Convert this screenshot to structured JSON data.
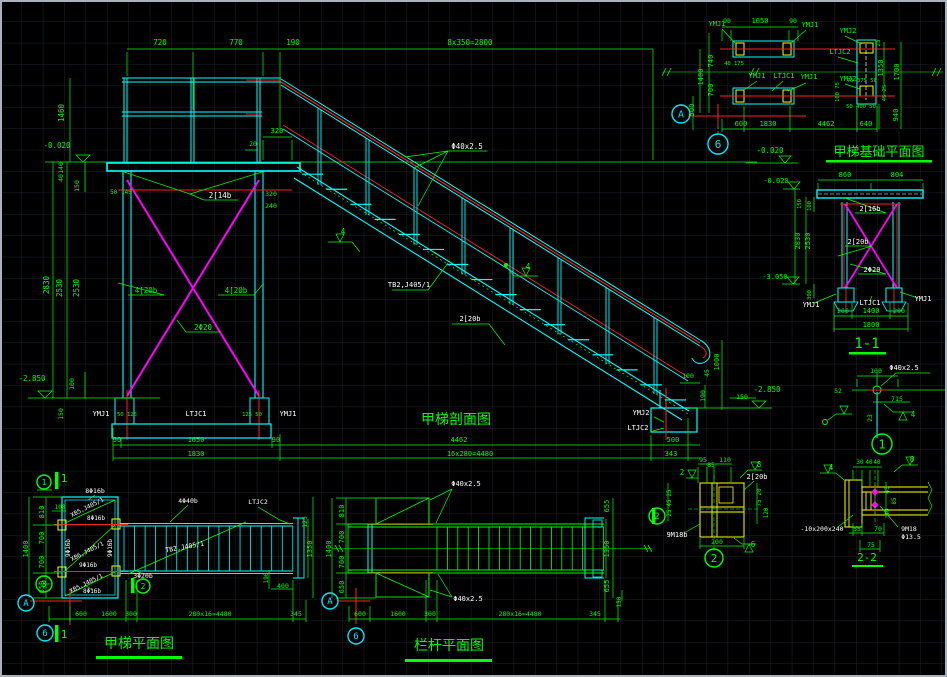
{
  "colors": {
    "line_cyan": "#00ffff",
    "line_green": "#00ff00",
    "line_red": "#ff2020",
    "line_magenta": "#ff00ff",
    "line_yellow": "#ffff00",
    "text_white": "#ffffff",
    "background": "#000000"
  },
  "views": {
    "foundation_plan": {
      "title": "甲梯基础平面图"
    },
    "section_1_1": {
      "title": "1-1"
    },
    "elevation": {
      "title": "甲梯剖面图"
    },
    "stair_plan": {
      "title": "甲梯平面图"
    },
    "railing_plan": {
      "title": "栏杆平面图"
    },
    "detail_2_2": {
      "title": "2-2"
    }
  },
  "texts": [
    {
      "x": 160,
      "y": 45,
      "t": "720"
    },
    {
      "x": 236,
      "y": 45,
      "t": "770"
    },
    {
      "x": 293,
      "y": 45,
      "t": "190"
    },
    {
      "x": 470,
      "y": 45,
      "t": "8x350=2800"
    },
    {
      "x": 64,
      "y": 113,
      "t": "1460",
      "r": -90
    },
    {
      "x": 57,
      "y": 148,
      "t": "-0.020"
    },
    {
      "x": 49,
      "y": 285,
      "t": "2830",
      "r": -90
    },
    {
      "x": 62,
      "y": 288,
      "t": "2530",
      "r": -90
    },
    {
      "x": 79,
      "y": 288,
      "t": "2530",
      "r": -90
    },
    {
      "x": 63,
      "y": 168,
      "t": "140",
      "r": -90,
      "s": 6.5
    },
    {
      "x": 63,
      "y": 178,
      "t": "40",
      "r": -90,
      "s": 6.5
    },
    {
      "x": 79,
      "y": 186,
      "t": "150",
      "r": -90,
      "s": 6.5
    },
    {
      "x": 74,
      "y": 384,
      "t": "100",
      "r": -90,
      "s": 6.5
    },
    {
      "x": 63,
      "y": 414,
      "t": "150",
      "r": -90,
      "s": 6.5
    },
    {
      "x": 32,
      "y": 381,
      "t": "-2.850"
    },
    {
      "x": 253,
      "y": 146,
      "t": "20",
      "s": 6.5
    },
    {
      "x": 277,
      "y": 133,
      "t": "320",
      "s": 7
    },
    {
      "x": 121,
      "y": 194,
      "t": "50 145",
      "s": 6
    },
    {
      "x": 271,
      "y": 196,
      "t": "320",
      "s": 6.5
    },
    {
      "x": 271,
      "y": 208,
      "t": "240",
      "s": 6.5
    },
    {
      "x": 127,
      "y": 416,
      "t": "50 125",
      "s": 5.5
    },
    {
      "x": 252,
      "y": 416,
      "t": "125 50",
      "s": 5.5
    },
    {
      "x": 117,
      "y": 442,
      "t": "90",
      "s": 7
    },
    {
      "x": 196,
      "y": 442,
      "t": "1650",
      "s": 7
    },
    {
      "x": 276,
      "y": 442,
      "t": "90",
      "s": 7
    },
    {
      "x": 459,
      "y": 442,
      "t": "4462",
      "s": 7
    },
    {
      "x": 196,
      "y": 456,
      "t": "1830",
      "s": 7
    },
    {
      "x": 470,
      "y": 456,
      "t": "16x280=4480",
      "s": 7
    },
    {
      "x": 688,
      "y": 378,
      "t": "100",
      "s": 6.5
    },
    {
      "x": 719,
      "y": 362,
      "t": "1000",
      "r": -90,
      "s": 7
    },
    {
      "x": 709,
      "y": 373,
      "t": "45",
      "r": -90,
      "s": 6.5
    },
    {
      "x": 742,
      "y": 399,
      "t": "150",
      "s": 6.5
    },
    {
      "x": 705,
      "y": 396,
      "t": "190",
      "r": -90,
      "s": 6.5
    },
    {
      "x": 767,
      "y": 392,
      "t": "-2.850"
    },
    {
      "x": 673,
      "y": 442,
      "t": "500",
      "s": 7
    },
    {
      "x": 671,
      "y": 456,
      "t": "343",
      "s": 7
    },
    {
      "x": 220,
      "y": 198,
      "t": "2[14b",
      "c": "w"
    },
    {
      "x": 146,
      "y": 293,
      "t": "4[20b"
    },
    {
      "x": 236,
      "y": 293,
      "t": "4[20b"
    },
    {
      "x": 203,
      "y": 330,
      "t": "2Φ20"
    },
    {
      "x": 101,
      "y": 416,
      "t": "YMJ1",
      "c": "w",
      "s": 7
    },
    {
      "x": 196,
      "y": 416,
      "t": "LTJC1",
      "c": "w",
      "s": 7
    },
    {
      "x": 288,
      "y": 416,
      "t": "YMJ1",
      "c": "w",
      "s": 7
    },
    {
      "x": 641,
      "y": 415,
      "t": "YMJ2",
      "c": "w",
      "s": 7
    },
    {
      "x": 638,
      "y": 430,
      "t": "LTJC2",
      "c": "w",
      "s": 7
    },
    {
      "x": 467,
      "y": 149,
      "t": "Φ40x2.5",
      "c": "w"
    },
    {
      "x": 409,
      "y": 287,
      "t": "TB2,J405/1",
      "c": "w",
      "s": 7
    },
    {
      "x": 470,
      "y": 321,
      "t": "2[20b",
      "c": "w",
      "s": 7
    },
    {
      "x": 343,
      "y": 234,
      "t": "4",
      "s": 7.5
    },
    {
      "x": 528,
      "y": 269,
      "t": "4",
      "s": 7.5
    },
    {
      "x": 717,
      "y": 26,
      "t": "YMJ1",
      "s": 7
    },
    {
      "x": 810,
      "y": 27,
      "t": "YMJ1",
      "s": 7
    },
    {
      "x": 848,
      "y": 33,
      "t": "YMJ2",
      "s": 7
    },
    {
      "x": 840,
      "y": 54,
      "t": "LTJC2",
      "s": 7
    },
    {
      "x": 757,
      "y": 78,
      "t": "YMJ1",
      "s": 7
    },
    {
      "x": 784,
      "y": 78,
      "t": "LTJC1",
      "s": 7
    },
    {
      "x": 809,
      "y": 79,
      "t": "YMJ1",
      "s": 7
    },
    {
      "x": 848,
      "y": 81,
      "t": "YMJ2",
      "s": 7
    },
    {
      "x": 727,
      "y": 23,
      "t": "90",
      "s": 6.5
    },
    {
      "x": 760,
      "y": 23,
      "t": "1050",
      "s": 7
    },
    {
      "x": 793,
      "y": 23,
      "t": "90",
      "s": 6.5
    },
    {
      "x": 713,
      "y": 61,
      "t": "740",
      "r": -90,
      "s": 7
    },
    {
      "x": 713,
      "y": 90,
      "t": "700",
      "r": -90,
      "s": 7
    },
    {
      "x": 703,
      "y": 77,
      "t": "1400",
      "r": -90,
      "s": 7
    },
    {
      "x": 694,
      "y": 110,
      "t": "500",
      "r": -90,
      "s": 7
    },
    {
      "x": 734,
      "y": 65,
      "t": "40 175",
      "s": 5.5
    },
    {
      "x": 862,
      "y": 82,
      "t": "75 375 50",
      "s": 5.5
    },
    {
      "x": 880,
      "y": 43,
      "t": "25",
      "r": -90,
      "s": 6
    },
    {
      "x": 883,
      "y": 68,
      "t": "1350",
      "r": -90,
      "s": 7
    },
    {
      "x": 899,
      "y": 72,
      "t": "1700",
      "r": -90,
      "s": 7
    },
    {
      "x": 886,
      "y": 93,
      "t": "45 25",
      "r": -90,
      "s": 5.5
    },
    {
      "x": 898,
      "y": 115,
      "t": "940",
      "r": -90,
      "s": 7
    },
    {
      "x": 861,
      "y": 108,
      "t": "50 400 50",
      "s": 5.5
    },
    {
      "x": 866,
      "y": 126,
      "t": "640",
      "s": 7
    },
    {
      "x": 741,
      "y": 126,
      "t": "600",
      "s": 7
    },
    {
      "x": 768,
      "y": 126,
      "t": "1830",
      "s": 7
    },
    {
      "x": 826,
      "y": 126,
      "t": "4462",
      "s": 7
    },
    {
      "x": 770,
      "y": 153,
      "t": "-0.020"
    },
    {
      "x": 839,
      "y": 92,
      "t": "100 75",
      "r": -90,
      "s": 5.5
    },
    {
      "x": 845,
      "y": 177,
      "t": "860",
      "s": 7
    },
    {
      "x": 897,
      "y": 177,
      "t": "804",
      "s": 7
    },
    {
      "x": 776,
      "y": 183,
      "t": "-0.020",
      "s": 7
    },
    {
      "x": 775,
      "y": 279,
      "t": "-3.050",
      "s": 7
    },
    {
      "x": 800,
      "y": 241,
      "t": "2830",
      "r": -90,
      "s": 7
    },
    {
      "x": 810,
      "y": 241,
      "t": "2530",
      "r": -90,
      "s": 7
    },
    {
      "x": 801,
      "y": 204,
      "t": "150",
      "r": -90,
      "s": 5.5
    },
    {
      "x": 811,
      "y": 206,
      "t": "100",
      "r": -90,
      "s": 5.5
    },
    {
      "x": 811,
      "y": 295,
      "t": "300",
      "r": -90,
      "s": 5.5
    },
    {
      "x": 870,
      "y": 211,
      "t": "2[16b",
      "c": "w",
      "s": 7
    },
    {
      "x": 858,
      "y": 244,
      "t": "2[20b",
      "c": "w",
      "s": 7
    },
    {
      "x": 872,
      "y": 272,
      "t": "2Φ20",
      "c": "w",
      "s": 7
    },
    {
      "x": 811,
      "y": 307,
      "t": "YMJ1",
      "c": "w",
      "s": 7
    },
    {
      "x": 870,
      "y": 305,
      "t": "LTJC1",
      "c": "w",
      "s": 7
    },
    {
      "x": 923,
      "y": 301,
      "t": "YMJ1",
      "c": "w",
      "s": 7
    },
    {
      "x": 843,
      "y": 313,
      "t": "200",
      "s": 6.5
    },
    {
      "x": 871,
      "y": 313,
      "t": "1400",
      "s": 7
    },
    {
      "x": 899,
      "y": 313,
      "t": "200",
      "s": 6.5
    },
    {
      "x": 871,
      "y": 327,
      "t": "1800",
      "s": 7
    },
    {
      "x": 876,
      "y": 373,
      "t": "100",
      "s": 6.5
    },
    {
      "x": 838,
      "y": 393,
      "t": "52",
      "s": 6.5
    },
    {
      "x": 897,
      "y": 401,
      "t": "715",
      "s": 6.5
    },
    {
      "x": 872,
      "y": 418,
      "t": "23",
      "r": -90,
      "s": 6.5
    },
    {
      "x": 913,
      "y": 417,
      "t": "4",
      "s": 7.5
    },
    {
      "x": 904,
      "y": 370,
      "t": "Φ40x2.5",
      "c": "w",
      "s": 7
    },
    {
      "x": 703,
      "y": 462,
      "t": "95",
      "s": 6.5
    },
    {
      "x": 711,
      "y": 467,
      "t": "85",
      "s": 6.5
    },
    {
      "x": 725,
      "y": 462,
      "t": "110",
      "s": 6.5
    },
    {
      "x": 717,
      "y": 544,
      "t": "200",
      "s": 6.5
    },
    {
      "x": 671,
      "y": 493,
      "t": "25",
      "r": -90,
      "s": 6
    },
    {
      "x": 671,
      "y": 503,
      "t": "45",
      "r": -90,
      "s": 6
    },
    {
      "x": 671,
      "y": 513,
      "t": "25",
      "r": -90,
      "s": 6
    },
    {
      "x": 761,
      "y": 492,
      "t": "20",
      "r": -90,
      "s": 6
    },
    {
      "x": 761,
      "y": 503,
      "t": "75",
      "r": -90,
      "s": 6
    },
    {
      "x": 768,
      "y": 513,
      "t": "120",
      "r": -90,
      "s": 6
    },
    {
      "x": 757,
      "y": 479,
      "t": "2[20b",
      "c": "w",
      "s": 7
    },
    {
      "x": 677,
      "y": 537,
      "t": "9M18b",
      "c": "w",
      "s": 7
    },
    {
      "x": 759,
      "y": 467,
      "t": "8",
      "s": 7.5
    },
    {
      "x": 753,
      "y": 547,
      "t": "6",
      "s": 7.5
    },
    {
      "x": 682,
      "y": 475,
      "t": "2",
      "s": 7.5
    },
    {
      "x": 860,
      "y": 464,
      "t": "30",
      "s": 6
    },
    {
      "x": 869,
      "y": 464,
      "t": "40",
      "s": 6
    },
    {
      "x": 877,
      "y": 464,
      "t": "40",
      "s": 6
    },
    {
      "x": 857,
      "y": 531,
      "t": "55",
      "s": 6.5
    },
    {
      "x": 878,
      "y": 531,
      "t": "70",
      "s": 6.5
    },
    {
      "x": 871,
      "y": 547,
      "t": "75",
      "s": 6.5
    },
    {
      "x": 889,
      "y": 490,
      "t": "45",
      "r": -90,
      "s": 6
    },
    {
      "x": 896,
      "y": 501,
      "t": "85",
      "r": -90,
      "s": 6
    },
    {
      "x": 889,
      "y": 512,
      "t": "40",
      "r": -90,
      "s": 6
    },
    {
      "x": 822,
      "y": 531,
      "t": "-10x200x240",
      "c": "w",
      "s": 6.5
    },
    {
      "x": 909,
      "y": 531,
      "t": "9M18",
      "c": "w",
      "s": 6.5
    },
    {
      "x": 911,
      "y": 539,
      "t": "Φ13.5",
      "c": "w",
      "s": 6.5
    },
    {
      "x": 831,
      "y": 470,
      "t": "4",
      "s": 7.5
    },
    {
      "x": 912,
      "y": 462,
      "t": "6",
      "s": 7.5
    },
    {
      "x": 44,
      "y": 512,
      "t": "810",
      "r": -90,
      "s": 7
    },
    {
      "x": 44,
      "y": 538,
      "t": "700",
      "r": -90,
      "s": 7
    },
    {
      "x": 44,
      "y": 562,
      "t": "700",
      "r": -90,
      "s": 7
    },
    {
      "x": 44,
      "y": 587,
      "t": "650",
      "r": -90,
      "s": 7
    },
    {
      "x": 28,
      "y": 549,
      "t": "1400",
      "r": -90,
      "s": 7
    },
    {
      "x": 60,
      "y": 509,
      "t": "100",
      "s": 6
    },
    {
      "x": 81,
      "y": 616,
      "t": "600",
      "s": 6.5
    },
    {
      "x": 109,
      "y": 616,
      "t": "1600",
      "s": 6.5
    },
    {
      "x": 131,
      "y": 616,
      "t": "300",
      "s": 6.5
    },
    {
      "x": 210,
      "y": 616,
      "t": "280x16=4480",
      "s": 6.5
    },
    {
      "x": 296,
      "y": 616,
      "t": "345",
      "s": 6.5
    },
    {
      "x": 307,
      "y": 522,
      "t": "125",
      "r": -90,
      "s": 6.5
    },
    {
      "x": 312,
      "y": 549,
      "t": "1350",
      "r": -90,
      "s": 7
    },
    {
      "x": 268,
      "y": 578,
      "t": "190",
      "r": -90,
      "s": 6
    },
    {
      "x": 283,
      "y": 588,
      "t": "400",
      "s": 6.5
    },
    {
      "x": 95,
      "y": 493,
      "t": "8Φ16b",
      "c": "w",
      "s": 6.5
    },
    {
      "x": 88,
      "y": 509,
      "t": "XB5,J405/1",
      "c": "w",
      "s": 6,
      "r": -27
    },
    {
      "x": 96,
      "y": 520,
      "t": "8Φ16b",
      "c": "w",
      "s": 6
    },
    {
      "x": 70,
      "y": 548,
      "t": "9Φ16b",
      "c": "w",
      "s": 6,
      "r": -90
    },
    {
      "x": 112,
      "y": 548,
      "t": "9Φ16b",
      "c": "w",
      "s": 6,
      "r": -90
    },
    {
      "x": 88,
      "y": 553,
      "t": "XB6,J405/1",
      "c": "w",
      "s": 6,
      "r": -27
    },
    {
      "x": 88,
      "y": 567,
      "t": "9Φ16b",
      "c": "w",
      "s": 6
    },
    {
      "x": 87,
      "y": 585,
      "t": "XB5,J405/1",
      "c": "w",
      "s": 6,
      "r": -27
    },
    {
      "x": 92,
      "y": 593,
      "t": "8Φ16b",
      "c": "w",
      "s": 6
    },
    {
      "x": 143,
      "y": 578,
      "t": "3Φ20b",
      "c": "w",
      "s": 6.5
    },
    {
      "x": 185,
      "y": 549,
      "t": "TB2,J405/1",
      "c": "w",
      "s": 6.5,
      "r": -10
    },
    {
      "x": 188,
      "y": 503,
      "t": "4Φ40b",
      "c": "w",
      "s": 6.5
    },
    {
      "x": 258,
      "y": 504,
      "t": "LTJC2",
      "c": "w",
      "s": 6.5
    },
    {
      "x": 64,
      "y": 482,
      "t": "1",
      "s": 11
    },
    {
      "x": 64,
      "y": 638,
      "t": "1",
      "s": 11
    },
    {
      "x": 466,
      "y": 486,
      "t": "Φ40x2.5",
      "c": "w",
      "s": 7
    },
    {
      "x": 468,
      "y": 601,
      "t": "Φ40x2.5",
      "c": "w",
      "s": 7
    },
    {
      "x": 344,
      "y": 511,
      "t": "810",
      "r": -90,
      "s": 7
    },
    {
      "x": 344,
      "y": 537,
      "t": "700",
      "r": -90,
      "s": 7
    },
    {
      "x": 344,
      "y": 562,
      "t": "700",
      "r": -90,
      "s": 7
    },
    {
      "x": 344,
      "y": 587,
      "t": "650",
      "r": -90,
      "s": 7
    },
    {
      "x": 331,
      "y": 549,
      "t": "1400",
      "r": -90,
      "s": 7
    },
    {
      "x": 609,
      "y": 506,
      "t": "655",
      "r": -90,
      "s": 7
    },
    {
      "x": 609,
      "y": 549,
      "t": "1350",
      "r": -90,
      "s": 7
    },
    {
      "x": 609,
      "y": 586,
      "t": "655",
      "r": -90,
      "s": 7
    },
    {
      "x": 621,
      "y": 602,
      "t": "150",
      "r": -90,
      "s": 6
    },
    {
      "x": 360,
      "y": 616,
      "t": "600",
      "s": 6.5
    },
    {
      "x": 398,
      "y": 616,
      "t": "1600",
      "s": 6.5
    },
    {
      "x": 430,
      "y": 616,
      "t": "300",
      "s": 6.5
    },
    {
      "x": 520,
      "y": 616,
      "t": "280x16=4480",
      "s": 6.5
    },
    {
      "x": 595,
      "y": 616,
      "t": "345",
      "s": 6.5
    }
  ],
  "markers": [
    {
      "x": 681,
      "y": 114,
      "r": 9,
      "t": "A",
      "c": "c",
      "s": 10
    },
    {
      "x": 718,
      "y": 144,
      "r": 10,
      "t": "6",
      "c": "c",
      "s": 11
    },
    {
      "x": 26,
      "y": 603,
      "r": 8,
      "t": "A",
      "c": "c",
      "s": 9
    },
    {
      "x": 45,
      "y": 633,
      "r": 8,
      "t": "6",
      "c": "c",
      "s": 9
    },
    {
      "x": 330,
      "y": 601,
      "r": 8,
      "t": "A",
      "c": "c",
      "s": 9
    },
    {
      "x": 356,
      "y": 636,
      "r": 8,
      "t": "6",
      "c": "c",
      "s": 9
    },
    {
      "x": 44,
      "y": 482,
      "r": 7,
      "t": "1",
      "c": "g",
      "s": 8
    },
    {
      "x": 44,
      "y": 584,
      "r": 8,
      "t": "3",
      "c": "g",
      "s": 9
    },
    {
      "x": 143,
      "y": 586,
      "r": 7,
      "t": "2",
      "c": "g",
      "s": 8
    },
    {
      "x": 882,
      "y": 444,
      "r": 10,
      "t": "1",
      "c": "g",
      "s": 12
    },
    {
      "x": 714,
      "y": 558,
      "r": 9,
      "t": "2",
      "c": "g",
      "s": 11
    },
    {
      "x": 657,
      "y": 516,
      "r": 8,
      "t": "2",
      "c": "g",
      "s": 9
    }
  ]
}
